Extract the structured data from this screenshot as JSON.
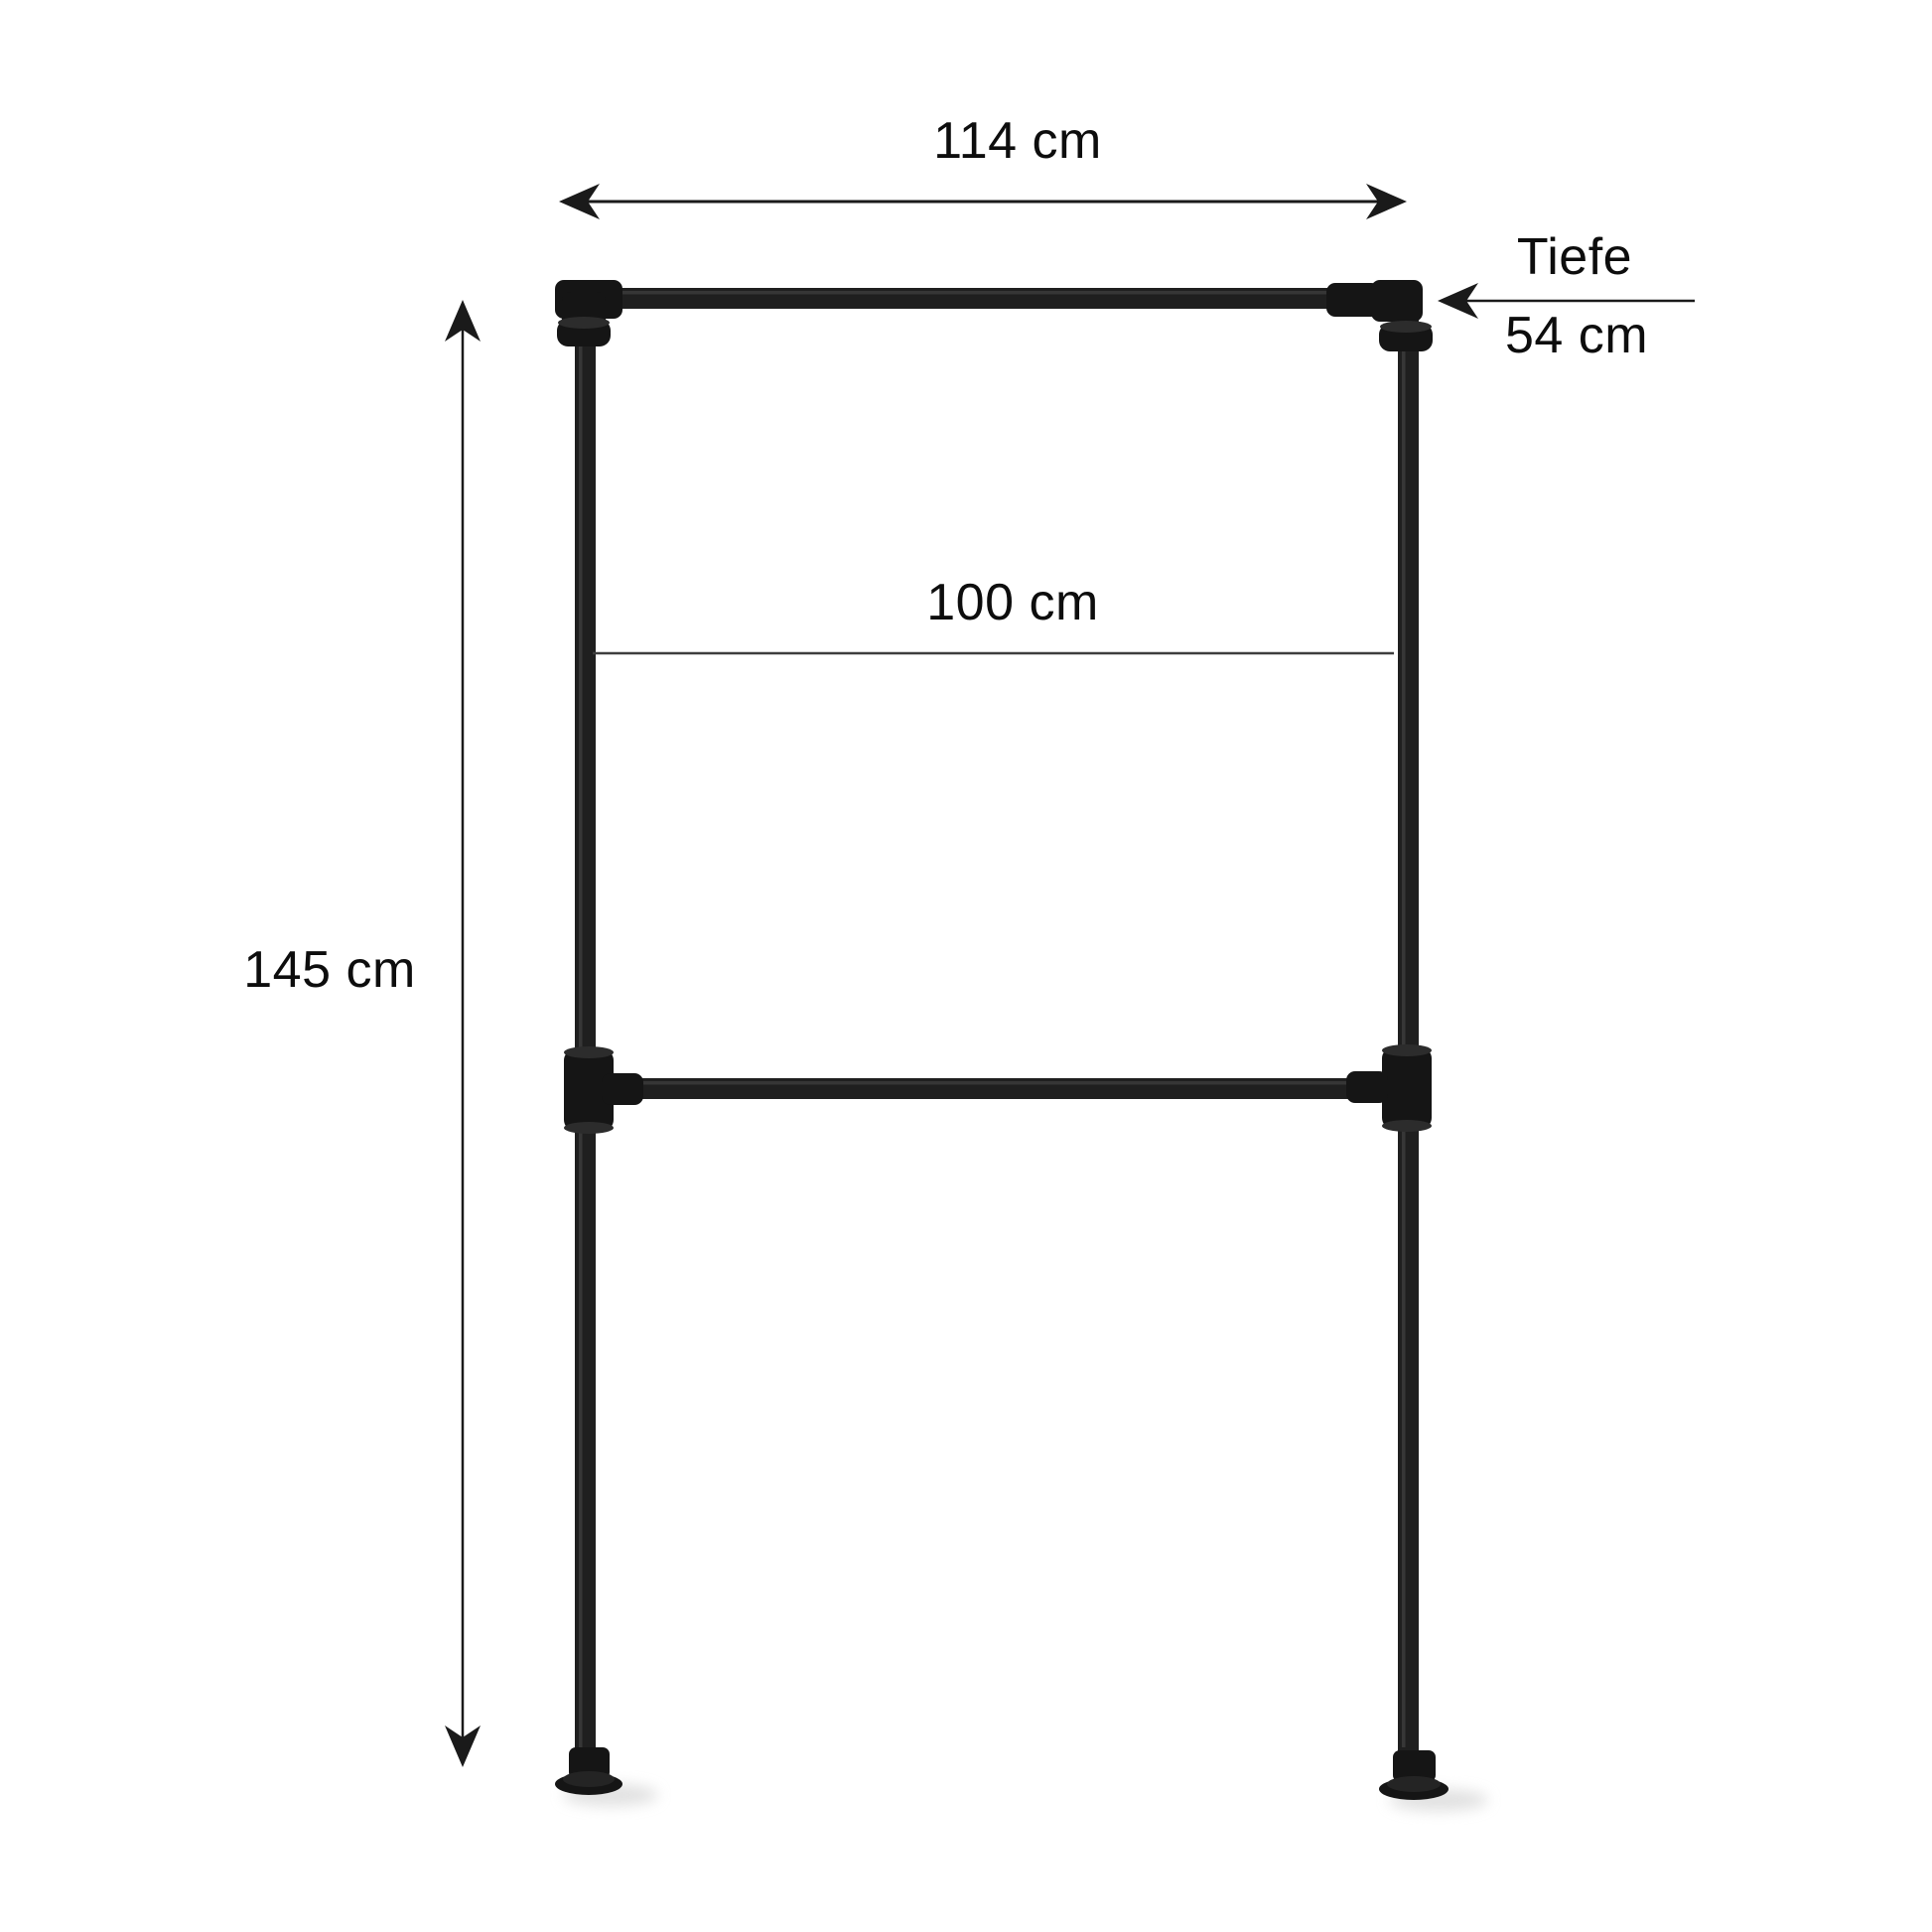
{
  "page": {
    "background": "#ffffff"
  },
  "labels": {
    "width_top": "114 cm",
    "depth_name": "Tiefe",
    "depth_value": "54 cm",
    "rail_width": "100 cm",
    "height": "145 cm"
  },
  "colors": {
    "pipe": "#1f1f1f",
    "fitting": "#151515",
    "dimension_line": "#1a1a1a",
    "rail_dimension_line": "#3d3d3d",
    "label_text": "#0d0d0d",
    "shadow": "#d9d9d9"
  }
}
